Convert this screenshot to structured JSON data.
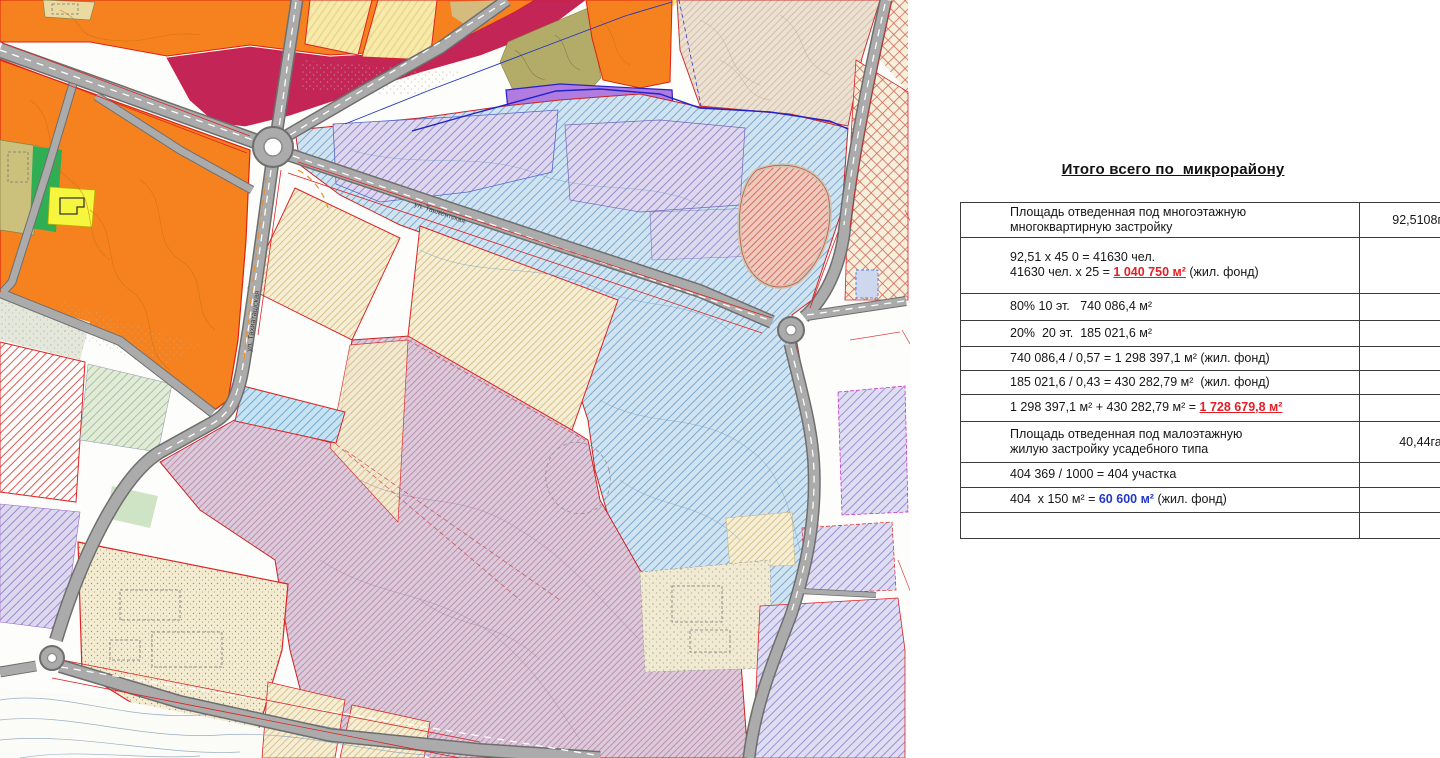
{
  "table": {
    "title": "Итого всего по  микрорайону",
    "rows": [
      {
        "h": 28,
        "c1": [
          {
            "t": "Площадь отведенная под многоэтажную\nмногоквартирную застройку"
          }
        ],
        "c2": "92,5108га"
      },
      {
        "h": 56,
        "c1": [
          {
            "t": "92,51 x 45 0 = 41630 чел.\n41630 чел. x 25 = "
          },
          {
            "t": "1 040 750 м²",
            "s": "red"
          },
          {
            "t": " (жил. фонд)"
          }
        ],
        "c2": ""
      },
      {
        "h": 27,
        "c1": [
          {
            "t": "80% 10 эт.   740 086,4 м²"
          }
        ],
        "c2": ""
      },
      {
        "h": 26,
        "c1": [
          {
            "t": "20%  20 эт.  185 021,6 м²"
          }
        ],
        "c2": ""
      },
      {
        "h": 24,
        "c1": [
          {
            "t": "740 086,4 / 0,57 = 1 298 397,1 м² (жил. фонд)"
          }
        ],
        "c2": ""
      },
      {
        "h": 24,
        "c1": [
          {
            "t": "185 021,6 / 0,43 = 430 282,79 м²  (жил. фонд)"
          }
        ],
        "c2": ""
      },
      {
        "h": 27,
        "c1": [
          {
            "t": "1 298 397,1 м² + 430 282,79 м² = "
          },
          {
            "t": "1 728 679,8 м²",
            "s": "red"
          }
        ],
        "c2": ""
      },
      {
        "h": 41,
        "c1": [
          {
            "t": "Площадь отведенная под малоэтажную\nжилую застройку усадебного типа"
          }
        ],
        "c2": "40,44га"
      },
      {
        "h": 25,
        "c1": [
          {
            "t": "404 369 / 1000 = 404 участка"
          }
        ],
        "c2": ""
      },
      {
        "h": 25,
        "c1": [
          {
            "t": "404  x 150 м² = "
          },
          {
            "t": "60 600 м²",
            "s": "blue"
          },
          {
            "t": " (жил. фонд)"
          }
        ],
        "c2": ""
      },
      {
        "h": 26,
        "c1": [
          {
            "t": ""
          }
        ],
        "c2": ""
      }
    ]
  },
  "map": {
    "streets": [
      {
        "name": "ул. Ташкентская"
      },
      {
        "name": "ул. Тахиаташская"
      }
    ],
    "colors": {
      "orange_zone": "#f5821f",
      "magenta_zone": "#c22556",
      "violet_zone": "#b07ce0",
      "blue_zone": "#cfe3f1",
      "mauve_zone": "#dcc9da",
      "road": "#ababab",
      "parcel_border": "#dd2222",
      "accent_red_text": "#e31e24",
      "accent_blue_text": "#2138c9"
    }
  }
}
